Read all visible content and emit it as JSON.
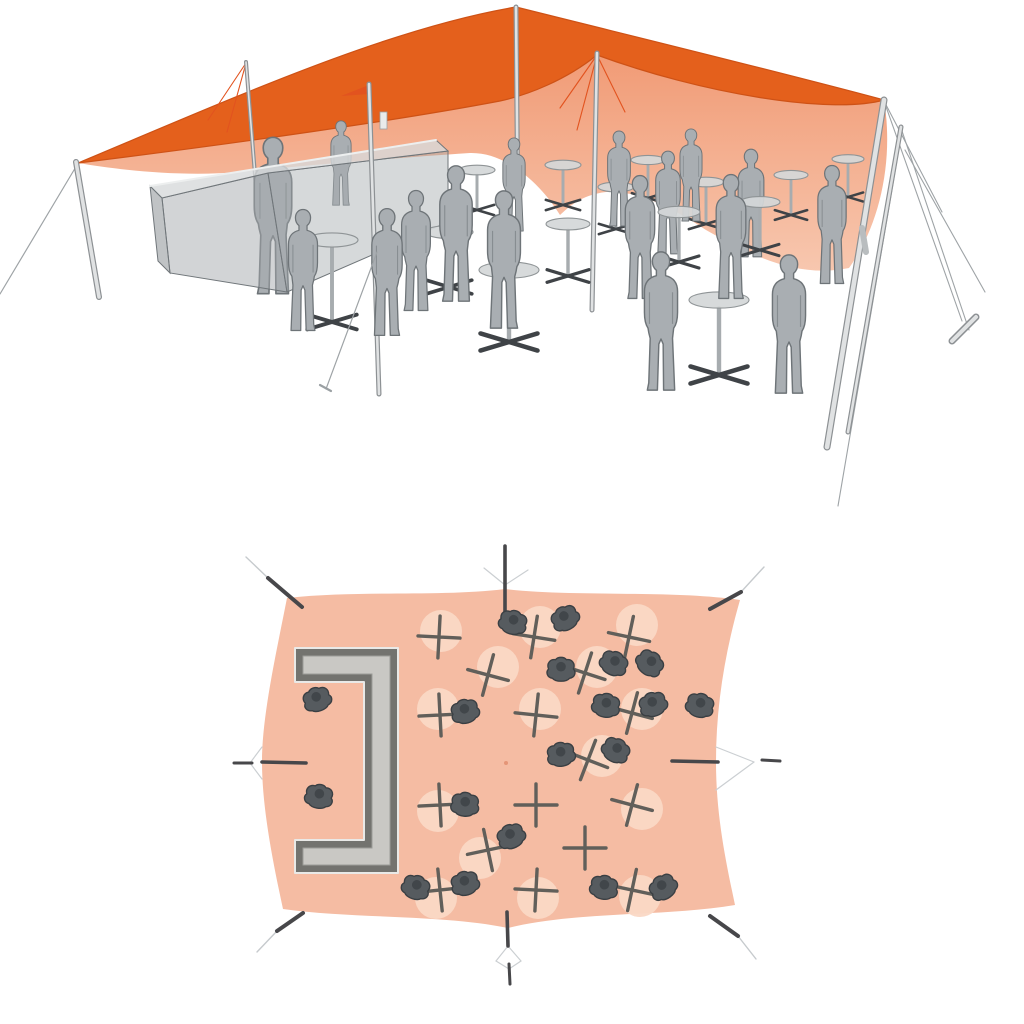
{
  "meta": {
    "description": "3D visualization of an orange stretch tent event setup: perspective view with bar counter, standing guests and bistro tables (top), and top-down plan view of the same layout (bottom)",
    "visible_text": []
  },
  "colors": {
    "canopy_top": "#E4601C",
    "canopy_top_edge": "#CE5216",
    "canopy_under_hi": "#F19C77",
    "canopy_under_lo": "#F8CBB4",
    "seam": "#E2531F",
    "pole_light": "#E0E2E3",
    "pole_dark": "#8D9194",
    "guy": "#9EA3A6",
    "figure_fill": "#A9AEB2",
    "figure_line": "#6E7478",
    "table_top": "#D4D7D8",
    "table_line": "#8F9496",
    "base_dark": "#3F4347",
    "bar_top": "#D7DADB",
    "bar_front": "#A5AAAD",
    "bar_line": "#70767A",
    "plan_tent": "#F5BCA3",
    "plan_circle": "#FAD8C5",
    "plan_bar_frame": "#73736F",
    "plan_bar_fill": "#C9C8C4",
    "plan_people": "#565B5F",
    "plan_people_line": "#3A3F43",
    "cross": "#615F5A",
    "anchor_dark": "#47474A",
    "anchor_light": "#C6CACD"
  },
  "perspective": {
    "canopy_under_path": "M78,163 C240,143 400,120 500,101 C528,95 566,80 597,55 C700,93 830,115 884,100 C894,160 880,225 849,268 C800,278 755,258 706,230 C668,205 635,190 606,192 C580,195 568,208 560,215 C545,190 510,152 470,153 C380,159 300,166 240,172 C180,177 120,170 78,163 Z",
    "canopy_top_path": "M78,163 C240,95 390,28 516,7 C640,38 780,72 884,100 C830,115 700,93 597,55 C566,80 528,95 500,101 C400,120 240,143 78,163 Z",
    "seam_lines": [
      [
        597,
        55,
        560,
        108
      ],
      [
        597,
        55,
        577,
        130
      ],
      [
        597,
        55,
        625,
        112
      ],
      [
        246,
        63,
        208,
        120
      ],
      [
        246,
        63,
        227,
        132
      ],
      [
        369,
        86,
        346,
        95
      ]
    ],
    "flare_path": "M369,85 L341,96 L369,94 Z",
    "poles_back": [
      [
        246,
        62,
        257,
        200,
        4
      ],
      [
        516,
        7,
        518,
        232,
        5
      ],
      [
        597,
        53,
        592,
        310,
        5
      ]
    ],
    "pole_bar": [
      369,
      84,
      379,
      394,
      5
    ],
    "pole_left": [
      76,
      162,
      99,
      297,
      6
    ],
    "poles_right": [
      [
        884,
        100,
        827,
        447,
        7
      ],
      [
        901,
        127,
        848,
        432,
        5
      ]
    ],
    "guy_left": [
      77,
      165,
      0,
      294
    ],
    "guys_right": [
      [
        884,
        101,
        962,
        321
      ],
      [
        884,
        101,
        942,
        212
      ],
      [
        901,
        128,
        969,
        330
      ],
      [
        897,
        160,
        838,
        506
      ],
      [
        905,
        150,
        985,
        292
      ]
    ],
    "stake_right": [
      952,
      341,
      976,
      317
    ],
    "cleat": [
      862,
      228,
      866,
      252
    ],
    "guy_center": [
      377,
      252,
      326,
      389
    ],
    "tick": [
      320,
      385,
      331,
      391
    ],
    "bar": {
      "top": "M150,186 L436,140 L448,151 L268,173 L162,198 Z",
      "front1": "M162,198 L268,173 L287,292 L170,273 Z",
      "front2": "M268,173 L448,151 L448,222 L287,292 Z",
      "left_end": "M150,186 L162,198 L170,273 L158,261 Z",
      "rim": [
        150,
        186,
        436,
        140
      ]
    },
    "bottle": [
      380,
      112,
      7,
      17
    ],
    "tables_far": [
      [
        477,
        170,
        18,
        40
      ],
      [
        563,
        165,
        18,
        40
      ],
      [
        616,
        187,
        18,
        42
      ],
      [
        648,
        160,
        17,
        38
      ],
      [
        706,
        182,
        18,
        42
      ],
      [
        791,
        175,
        17,
        40
      ],
      [
        848,
        159,
        16,
        38
      ]
    ],
    "tables_near": [
      [
        679,
        212,
        21,
        50
      ],
      [
        760,
        202,
        20,
        48
      ],
      [
        568,
        224,
        22,
        52
      ],
      [
        449,
        232,
        24,
        55
      ],
      [
        332,
        240,
        26,
        82
      ],
      [
        509,
        270,
        30,
        72
      ],
      [
        719,
        300,
        30,
        75
      ]
    ],
    "figures_far": [
      [
        691,
        223,
        96,
        1
      ],
      [
        619,
        228,
        99,
        1
      ],
      [
        514,
        233,
        97,
        1
      ],
      [
        668,
        256,
        107,
        -1
      ],
      [
        751,
        259,
        112,
        1
      ]
    ],
    "figures_bar": [
      [
        273,
        297,
        163,
        1
      ],
      [
        341,
        207,
        88,
        -1
      ]
    ],
    "figures_near": [
      [
        832,
        286,
        123,
        -1
      ],
      [
        640,
        301,
        128,
        1
      ],
      [
        731,
        301,
        129,
        -1
      ],
      [
        456,
        304,
        141,
        1
      ],
      [
        416,
        313,
        125,
        1
      ],
      [
        504,
        331,
        143,
        -1
      ],
      [
        303,
        333,
        126,
        -1
      ],
      [
        387,
        338,
        132,
        -1
      ],
      [
        661,
        393,
        144,
        1
      ],
      [
        789,
        396,
        144,
        -1
      ]
    ]
  },
  "plan": {
    "footprint_path": "M287,598 C360,590 442,597 505,589 C572,597 672,590 740,600 C725,652 716,706 716,762 C716,816 726,862 735,905 C662,917 578,911 508,928 C440,914 352,919 283,909 C272,858 262,806 262,762 C262,716 276,654 287,598 Z",
    "center_dot": [
      506,
      763
    ],
    "bar": {
      "outer": "M295,648 L398,648 L398,873 L295,873 L295,840 L364,840 L364,682 L295,682 Z",
      "inner": "M303,656 L390,656 L390,865 L303,865 L303,848 L372,848 L372,674 L303,674 Z"
    },
    "corner_anchors": [
      {
        "stake": [
          302,
          607,
          268,
          578
        ],
        "ext": [
          268,
          578,
          246,
          557
        ]
      },
      {
        "stake": [
          710,
          609,
          741,
          592
        ],
        "ext": [
          741,
          592,
          764,
          567
        ]
      },
      {
        "stake": [
          710,
          916,
          738,
          936
        ],
        "ext": [
          738,
          936,
          756,
          959
        ]
      },
      {
        "stake": [
          303,
          913,
          277,
          931
        ],
        "ext": [
          277,
          931,
          257,
          952
        ]
      }
    ],
    "edge_anchors": [
      {
        "pole": [
          505,
          546,
          505,
          612
        ],
        "v": [
          [
            505,
            585,
            484,
            568
          ],
          [
            505,
            585,
            528,
            570
          ]
        ]
      },
      {
        "pole": [
          507,
          912,
          508,
          946
        ],
        "stake": [
          509,
          964,
          510,
          984
        ],
        "v": [
          [
            508,
            946,
            496,
            961
          ],
          [
            508,
            946,
            521,
            961
          ],
          [
            496,
            961,
            509,
            969
          ],
          [
            521,
            961,
            509,
            969
          ]
        ]
      },
      {
        "pole": [
          262,
          762,
          306,
          763
        ],
        "stake": [
          234,
          763,
          252,
          763
        ],
        "v": [
          [
            262,
            747,
            250,
            763
          ],
          [
            262,
            779,
            250,
            763
          ]
        ]
      },
      {
        "pole": [
          672,
          761,
          718,
          762
        ],
        "stake": [
          762,
          760,
          780,
          761
        ],
        "v": [
          [
            716,
            747,
            754,
            762
          ],
          [
            716,
            790,
            754,
            762
          ]
        ]
      }
    ],
    "tables": [
      [
        439,
        637,
        2,
        -6,
        1
      ],
      [
        534,
        637,
        6,
        -10,
        1
      ],
      [
        629,
        637,
        8,
        -12,
        1
      ],
      [
        488,
        675,
        10,
        -8,
        1
      ],
      [
        585,
        673,
        12,
        -6,
        1
      ],
      [
        440,
        715,
        -2,
        -6,
        1
      ],
      [
        536,
        715,
        4,
        -6,
        1
      ],
      [
        632,
        713,
        10,
        -4,
        1
      ],
      [
        588,
        760,
        14,
        -4,
        1
      ],
      [
        440,
        805,
        -2,
        6,
        1
      ],
      [
        536,
        805,
        0,
        0,
        0
      ],
      [
        632,
        805,
        10,
        4,
        1
      ],
      [
        488,
        850,
        -8,
        8,
        1
      ],
      [
        585,
        848,
        0,
        0,
        0
      ],
      [
        440,
        890,
        -4,
        8,
        1
      ],
      [
        536,
        890,
        2,
        8,
        1
      ],
      [
        632,
        890,
        8,
        6,
        1
      ]
    ],
    "people": [
      [
        317,
        699,
        -20
      ],
      [
        319,
        796,
        10
      ],
      [
        513,
        622,
        15
      ],
      [
        565,
        618,
        -30
      ],
      [
        561,
        669,
        0
      ],
      [
        614,
        663,
        25
      ],
      [
        465,
        711,
        -15
      ],
      [
        606,
        705,
        10
      ],
      [
        650,
        663,
        40
      ],
      [
        653,
        704,
        -20
      ],
      [
        700,
        705,
        15
      ],
      [
        561,
        754,
        -10
      ],
      [
        616,
        750,
        30
      ],
      [
        465,
        804,
        5
      ],
      [
        511,
        836,
        -25
      ],
      [
        416,
        887,
        20
      ],
      [
        465,
        883,
        -15
      ],
      [
        604,
        887,
        10
      ],
      [
        663,
        887,
        -35
      ]
    ]
  }
}
